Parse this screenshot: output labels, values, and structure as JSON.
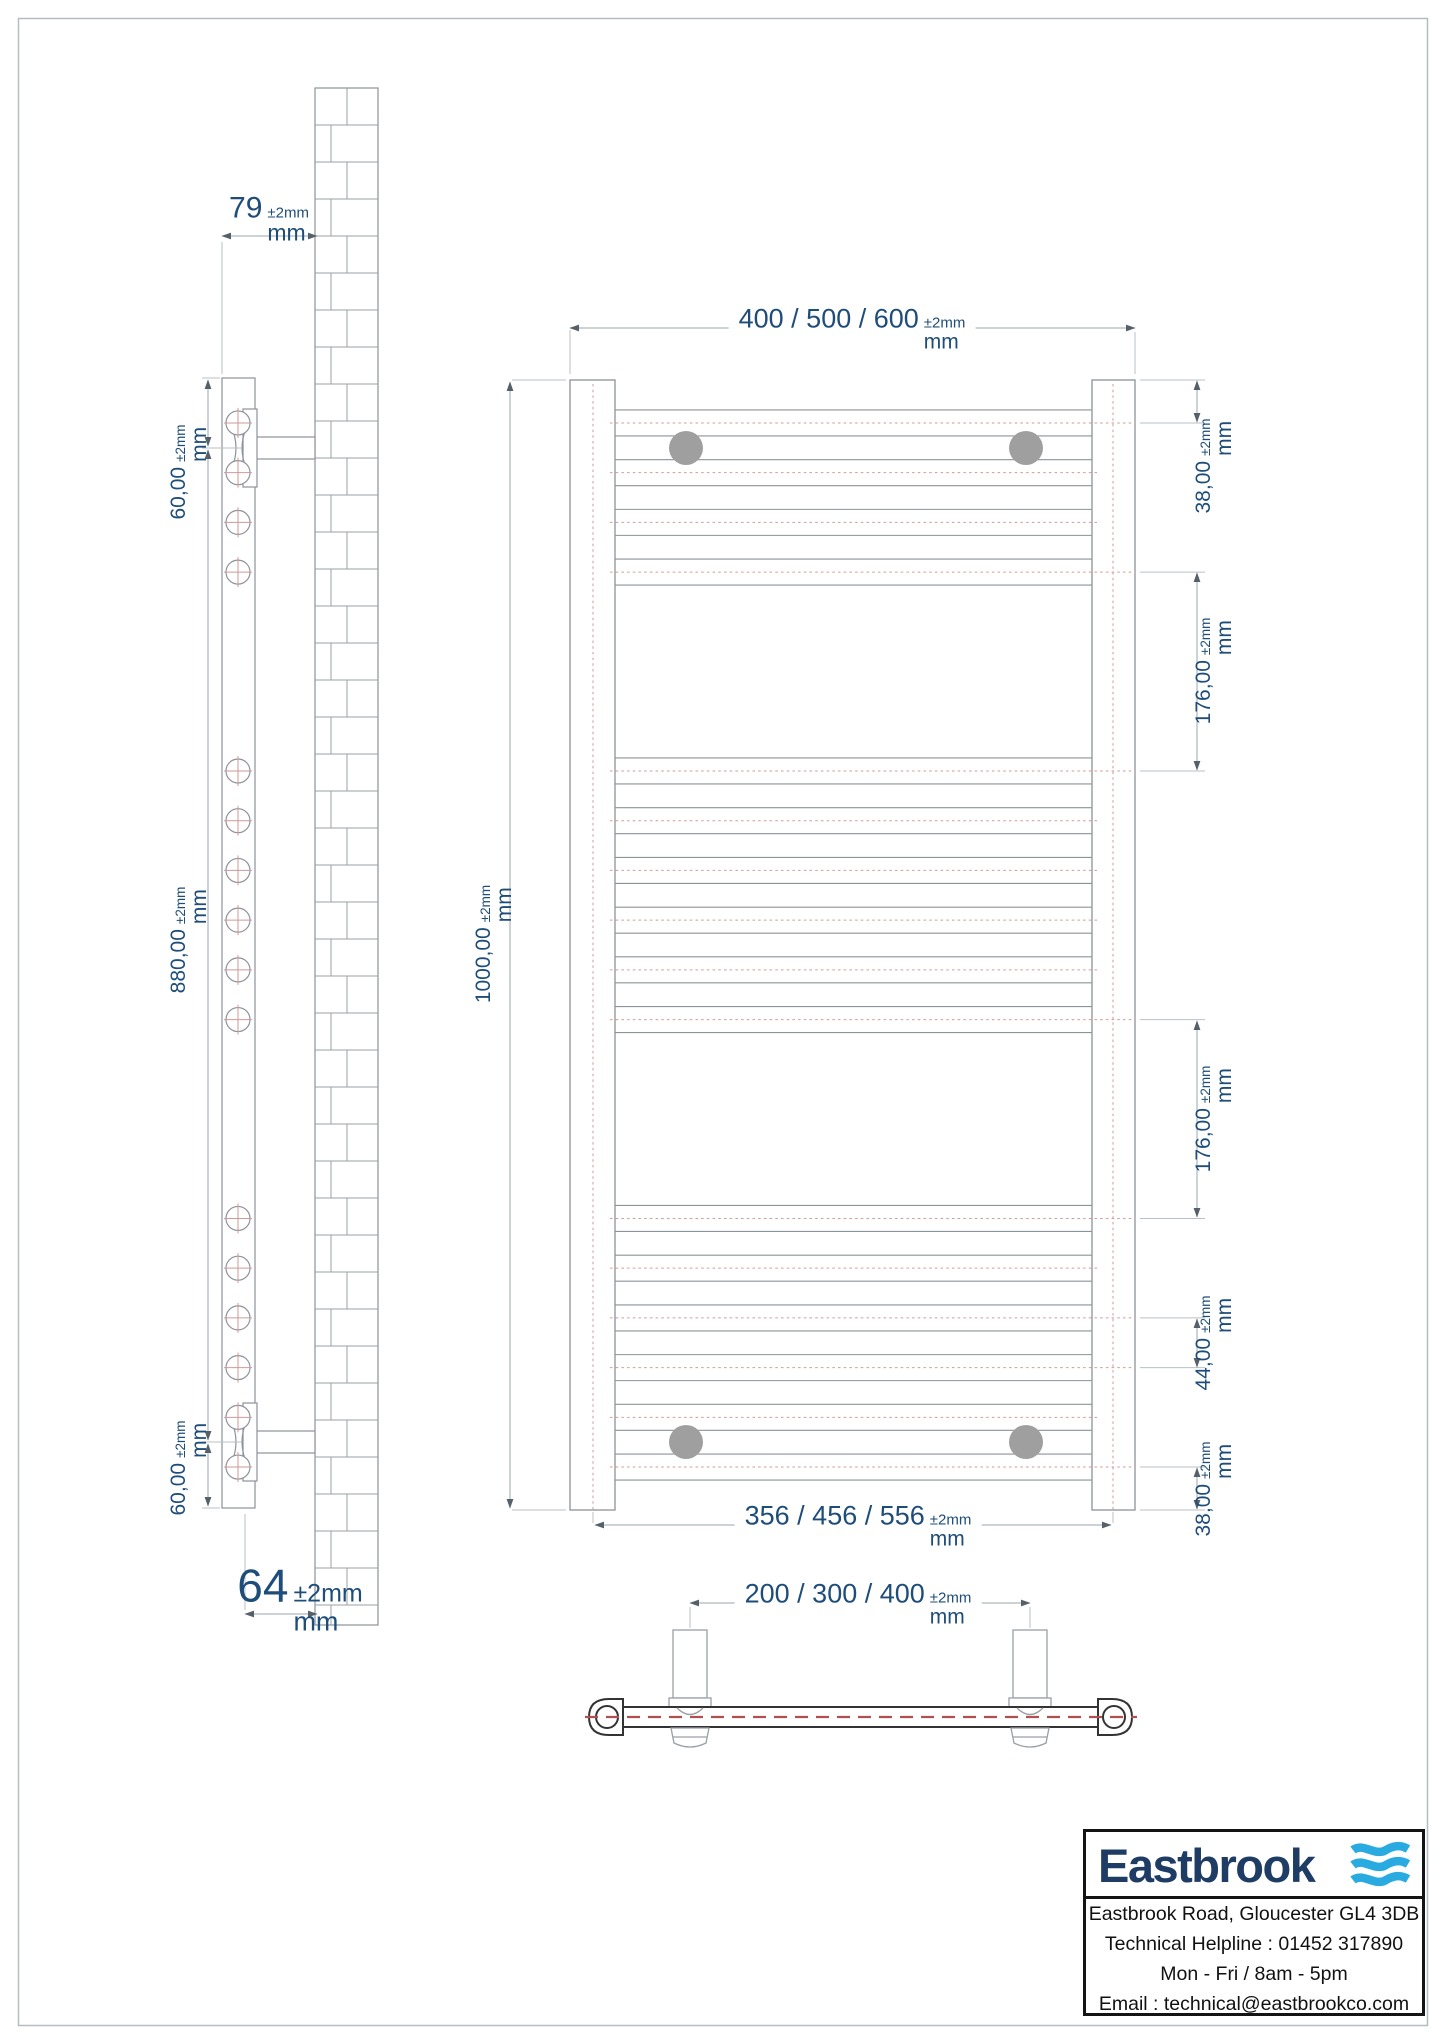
{
  "sheet": {
    "background": "#ffffff",
    "border_color": "#b7bcc2"
  },
  "colors": {
    "dimension_text": "#1e4d79",
    "geometry_line": "#8d939a",
    "extension_line": "#b9c0c6",
    "dimension_line": "#9aa5ad",
    "arrow": "#55606a",
    "centerline_red": "#cf9a9a",
    "topview_line": "#333333",
    "topview_centerline": "#b05050",
    "bracket_dot": "#9f9f9f",
    "logo_navy": "#1e3c64",
    "logo_wave_blue": "#29abe2",
    "info_text": "#111111"
  },
  "side_view": {
    "dim_wall_offset": {
      "value": "79",
      "unit": "mm",
      "tol": "±2mm"
    },
    "dim_bracket_top": {
      "value": "60,00",
      "unit": "mm",
      "tol": "±2mm"
    },
    "dim_bracket_span": {
      "value": "880,00",
      "unit": "mm",
      "tol": "±2mm"
    },
    "dim_bracket_bottom": {
      "value": "60,00",
      "unit": "mm",
      "tol": "±2mm"
    },
    "dim_depth": {
      "value": "64",
      "unit": "mm",
      "tol": "±2mm"
    }
  },
  "front_view": {
    "dim_width": {
      "value": "400 / 500 / 600",
      "unit": "mm",
      "tol": "±2mm"
    },
    "dim_height": {
      "value": "1000,00",
      "unit": "mm",
      "tol": "±2mm"
    },
    "dim_top_to_first_tube": {
      "value": "38,00",
      "unit": "mm",
      "tol": "±2mm"
    },
    "dim_towel_gap_upper": {
      "value": "176,00",
      "unit": "mm",
      "tol": "±2mm"
    },
    "dim_towel_gap_lower": {
      "value": "176,00",
      "unit": "mm",
      "tol": "±2mm"
    },
    "dim_tube_pitch": {
      "value": "44,00",
      "unit": "mm",
      "tol": "±2mm"
    },
    "dim_last_tube_to_bottom": {
      "value": "38,00",
      "unit": "mm",
      "tol": "±2mm"
    },
    "dim_pipe_centres": {
      "value": "356 / 456 / 556",
      "unit": "mm",
      "tol": "±2mm"
    }
  },
  "top_view": {
    "dim_valve_centres": {
      "value": "200 / 300 / 400",
      "unit": "mm",
      "tol": "±2mm"
    }
  },
  "info_box": {
    "brand": "Eastbrook",
    "lines": [
      "Eastbrook Road, Gloucester GL4 3DB",
      "Technical Helpline : 01452 317890",
      "Mon - Fri / 8am - 5pm",
      "Email : technical@eastbrookco.com"
    ]
  },
  "drawing": {
    "tube_centres_mm": [
      38,
      82,
      126,
      170,
      346,
      390,
      434,
      478,
      522,
      566,
      742,
      786,
      830,
      874,
      918,
      962
    ],
    "dimensioned_tube_mm": [
      38,
      170,
      346,
      566,
      742,
      830,
      874,
      962
    ],
    "scale_px_per_mm": 1.13,
    "front_top_px": 380,
    "tube_half_px": 13
  }
}
